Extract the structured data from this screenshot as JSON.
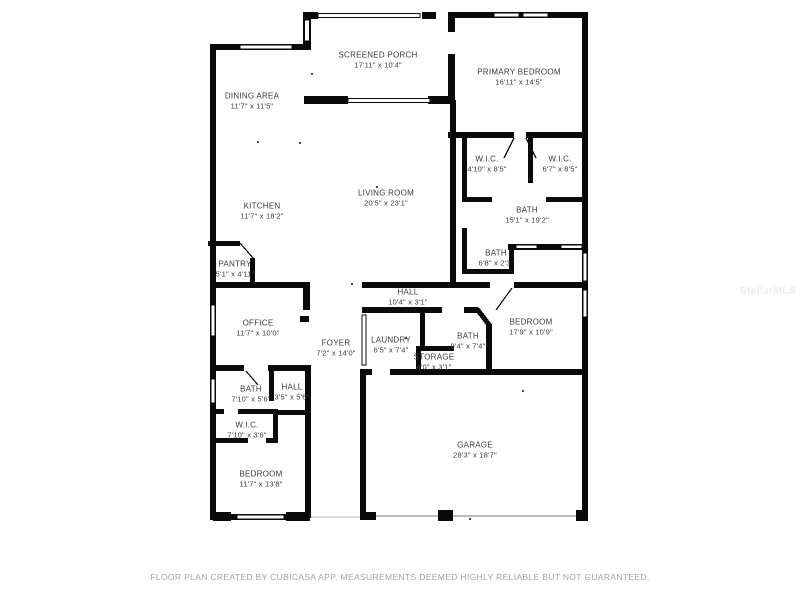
{
  "floor_plan": {
    "wall_color": "#0a0a0a",
    "label_color": "#3a3a3a",
    "rooms": [
      {
        "key": "screened-porch",
        "name": "SCREENED PORCH",
        "dims": "17'11\" x 10'4\"",
        "cx": 378,
        "cy": 60
      },
      {
        "key": "dining-area",
        "name": "DINING AREA",
        "dims": "11'7\" x 11'5\"",
        "cx": 252,
        "cy": 101
      },
      {
        "key": "primary-bedroom",
        "name": "PRIMARY BEDROOM",
        "dims": "16'11\" x 14'5\"",
        "cx": 519,
        "cy": 77
      },
      {
        "key": "wic-primary-left",
        "name": "W.I.C.",
        "dims": "4'10\" x 8'5\"",
        "cx": 487,
        "cy": 164
      },
      {
        "key": "wic-primary-right",
        "name": "W.I.C.",
        "dims": "6'7\" x 8'5\"",
        "cx": 560,
        "cy": 164
      },
      {
        "key": "living-room",
        "name": "LIVING ROOM",
        "dims": "20'5\" x 23'1\"",
        "cx": 386,
        "cy": 198
      },
      {
        "key": "kitchen",
        "name": "KITCHEN",
        "dims": "11'7\" x 18'2\"",
        "cx": 262,
        "cy": 211
      },
      {
        "key": "primary-bath",
        "name": "BATH",
        "dims": "15'1\" x 19'2\"",
        "cx": 527,
        "cy": 215
      },
      {
        "key": "bath-small",
        "name": "BATH",
        "dims": "6'8\" x 2'3\"",
        "cx": 496,
        "cy": 258
      },
      {
        "key": "pantry",
        "name": "PANTRY",
        "dims": "5'1\" x 4'11\"",
        "cx": 235,
        "cy": 269
      },
      {
        "key": "hall-main",
        "name": "HALL",
        "dims": "10'4\" x 3'1\"",
        "cx": 408,
        "cy": 297
      },
      {
        "key": "office",
        "name": "OFFICE",
        "dims": "11'7\" x 10'0\"",
        "cx": 258,
        "cy": 328
      },
      {
        "key": "foyer",
        "name": "FOYER",
        "dims": "7'2\" x 14'0\"",
        "cx": 336,
        "cy": 348
      },
      {
        "key": "laundry",
        "name": "LAUNDRY",
        "dims": "6'5\" x 7'4\"",
        "cx": 391,
        "cy": 345
      },
      {
        "key": "bath-guest",
        "name": "BATH",
        "dims": "9'4\" x 7'4\"",
        "cx": 468,
        "cy": 341
      },
      {
        "key": "storage",
        "name": "STORAGE",
        "dims": "4'0\" x 3'1\"",
        "cx": 434,
        "cy": 362
      },
      {
        "key": "bedroom-2",
        "name": "BEDROOM",
        "dims": "17'9\" x 10'9\"",
        "cx": 531,
        "cy": 327
      },
      {
        "key": "bath-3",
        "name": "BATH",
        "dims": "7'10\" x 5'6\"",
        "cx": 251,
        "cy": 394
      },
      {
        "key": "hall-small",
        "name": "HALL",
        "dims": "3'5\" x 5'6\"",
        "cx": 292,
        "cy": 392
      },
      {
        "key": "wic-bedroom",
        "name": "W.I.C.",
        "dims": "7'10\" x 3'6\"",
        "cx": 247,
        "cy": 430
      },
      {
        "key": "bedroom-3",
        "name": "BEDROOM",
        "dims": "11'7\" x 13'8\"",
        "cx": 261,
        "cy": 479
      },
      {
        "key": "garage",
        "name": "GARAGE",
        "dims": "28'3\" x 18'7\"",
        "cx": 475,
        "cy": 450
      }
    ]
  },
  "watermark": {
    "text": "StellarMLS"
  },
  "footer": {
    "disclaimer": "FLOOR PLAN CREATED BY CUBICASA APP. MEASUREMENTS DEEMED HIGHLY RELIABLE BUT NOT GUARANTEED."
  }
}
